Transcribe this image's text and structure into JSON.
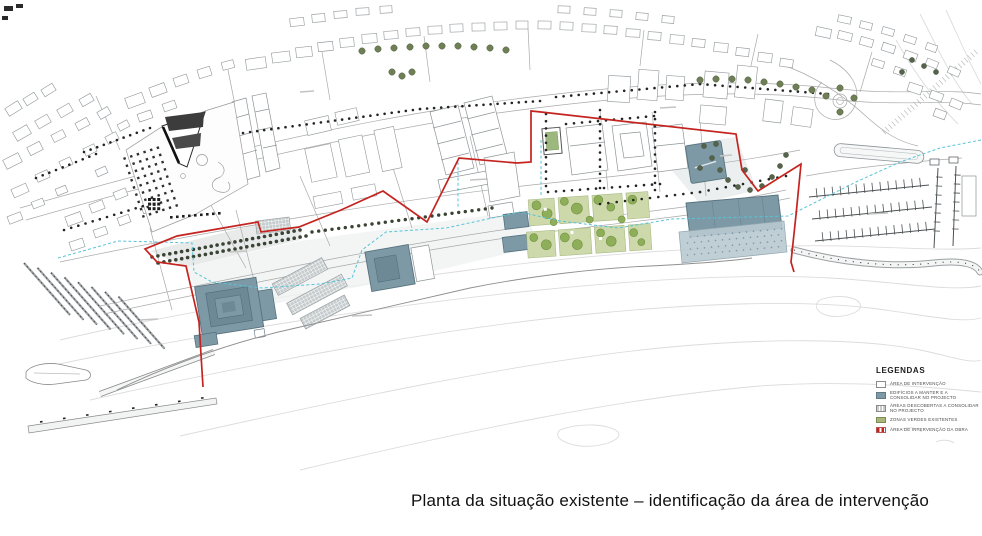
{
  "caption": "Planta da situação existente – identificação da área de intervenção",
  "legend": {
    "title": "LEGENDAS",
    "items": [
      {
        "label": "Área de intervenção",
        "swatch": "plain"
      },
      {
        "label": "Edifícios a manter e a consolidar no projecto",
        "swatch": "solid"
      },
      {
        "label": "Áreas descobertas a consolidar no projecto",
        "swatch": "grid"
      },
      {
        "label": "Zonas verdes existentes",
        "swatch": "green"
      },
      {
        "label": "Área de intervenção da obra",
        "swatch": "red-dash"
      }
    ]
  },
  "colors": {
    "boundary_red": "#C4241F",
    "building_slate": "#7E99A6",
    "building_slate_dark": "#6D8996",
    "apron_blue": "#B9C9D1",
    "park_parcel_green": "#CDD9AB",
    "tree_green": "#8FAE5A",
    "utility_cyan": "#56C3D8",
    "contour_gray": "#DCDCDC",
    "outline_gray": "#8F9598"
  }
}
